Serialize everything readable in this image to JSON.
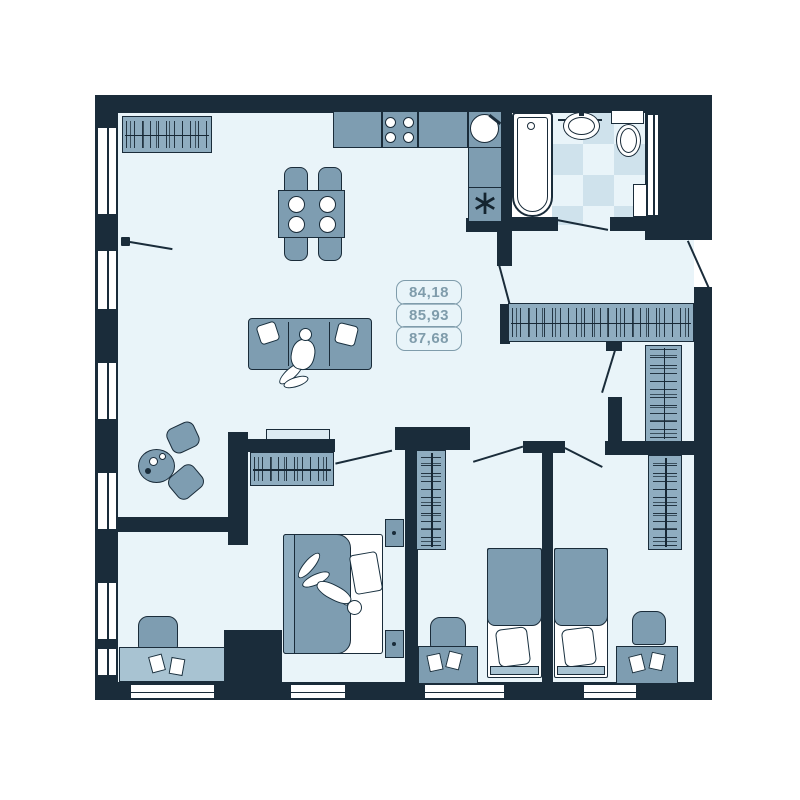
{
  "plan": {
    "type": "apartment-floor-plan",
    "area_values": [
      "84,18",
      "85,93",
      "87,68"
    ],
    "appliance_icon_char": "∗",
    "rooms": [
      "living-kitchen",
      "hallway",
      "bathroom",
      "master-bedroom",
      "study-nook",
      "bedroom-2",
      "bedroom-3",
      "dressing-room"
    ],
    "furnishings": [
      "wardrobe-with-hangers",
      "kitchen-counter",
      "stove-4-burners",
      "kitchen-sink",
      "dining-table-4-chairs",
      "sofa-3-seat",
      "round-coffee-table",
      "armchairs",
      "tv-console",
      "double-bed",
      "nightstands",
      "single-bed",
      "desk-with-papers",
      "desk-chair",
      "bathtub",
      "wash-basin",
      "toilet",
      "checkered-tile-floor",
      "windows",
      "door-swings",
      "person-sitting",
      "person-lying"
    ]
  },
  "palette": {
    "wall": "#1a2c3a",
    "floor": "#e9f4f9",
    "furniture": "#7e9db1",
    "furniture_light": "#a8c3d2",
    "wardrobe": "#8fadc0",
    "tile_dark": "#cfe2ec",
    "label_outline": "#7f9cab",
    "fixture_white": "#ffffff"
  }
}
